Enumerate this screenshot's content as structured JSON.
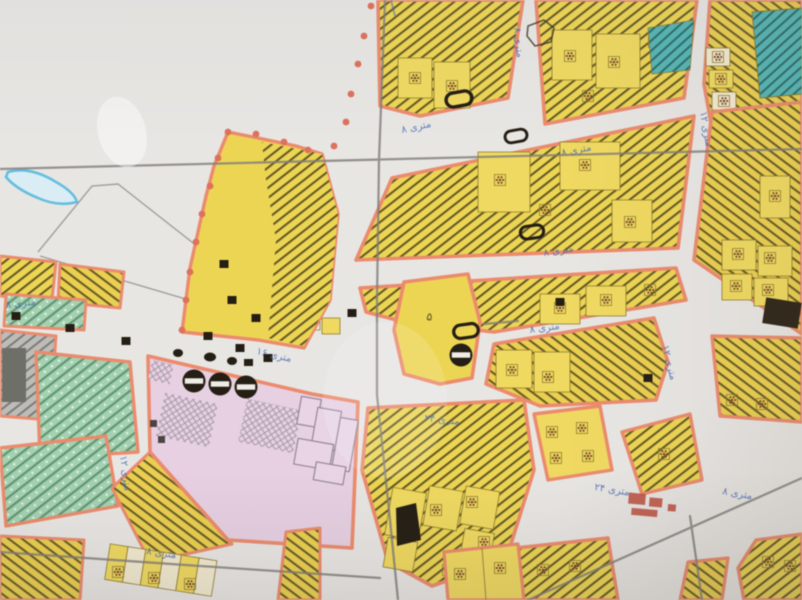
{
  "meta": {
    "type": "photograph of a paper urban zoning / land-use map",
    "script_on_map": "Persian handwritten street labels in blue ink"
  },
  "palette": {
    "paper": "#e8e6e3",
    "parcel_yellow": "#eed54f",
    "parcel_pale": "#f2e9cf",
    "hatch_olive": "#46401a",
    "road_edge_salmon": "#ee8a6b",
    "scallop_red": "#e0705a",
    "pink_block": "#e7d0e2",
    "green_block": "#a3d2b0",
    "green_hatch": "#47815d",
    "teal_block": "#52b7b6",
    "teal_hatch": "#1d5a58",
    "grey_block": "#bdbcb8",
    "grey_hatch": "#72716c",
    "water_blue": "#62bfe0",
    "ink_blue": "#3f66b5",
    "pencil_grey": "#807d79",
    "symbol_black": "#241e14",
    "stamp_red": "#c04c3c"
  },
  "street_labels": [
    "۸ متری",
    "۱۶ متری",
    "۸ متری",
    "۸ متری",
    "۱۲ متری",
    "۱۲ متری",
    "۲۴ متری",
    "۲۴ متری",
    "۱۲ متری",
    "۸ متری",
    "۸ متری",
    "۸ متری",
    "۸ متری",
    "۸ متری"
  ],
  "parcel_labels": {
    "block_number": "۵"
  },
  "icons": {
    "circle-bar-icon": "filled circle with white horizontal bar (tank/utility symbol)",
    "stadium-icon": "rounded-rectangle outline symbol",
    "orchard-icon": "small square with cluster of brown dots",
    "building-icon": "small black square",
    "scallop-dot-icon": "red boundary dot"
  }
}
